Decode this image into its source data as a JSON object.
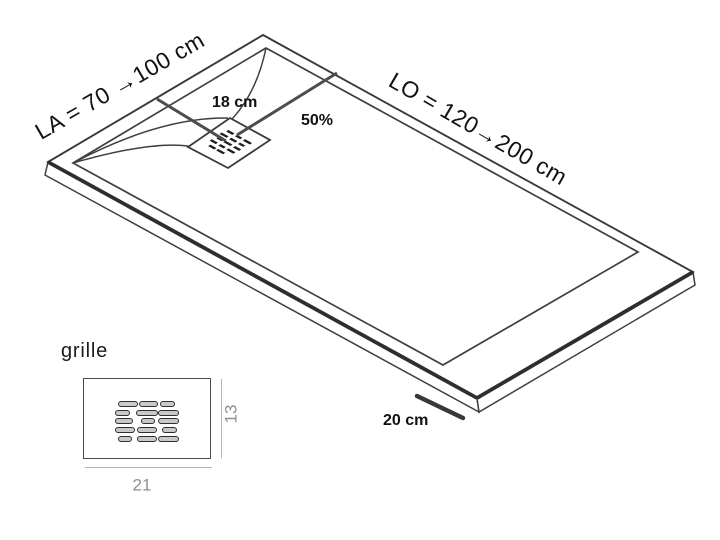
{
  "diagram": {
    "la_label": "LA = 70 →100 cm",
    "lo_label": "LO = 120→200 cm",
    "drain_distance_label": "18 cm",
    "drain_position_label": "50%",
    "border_width_label": "20 cm",
    "colors": {
      "line": "#3f3f3f",
      "thick_edge": "#2e2e2e",
      "leader": "#4d4d4d",
      "text": "#111111",
      "dim_text": "#8f8f8f",
      "slot_fill": "#c9c9c9",
      "drain_slot": "#1f1f1f"
    },
    "drain_slot_rows": [
      {
        "y": 14,
        "slots": [
          {
            "x": 10,
            "w": 7
          },
          {
            "x": 20,
            "w": 6
          },
          {
            "x": 29,
            "w": 8
          }
        ]
      },
      {
        "y": 20,
        "slots": [
          {
            "x": 8,
            "w": 8
          },
          {
            "x": 19,
            "w": 7
          },
          {
            "x": 29,
            "w": 6
          }
        ]
      },
      {
        "y": 26,
        "slots": [
          {
            "x": 10,
            "w": 6
          },
          {
            "x": 18,
            "w": 8
          },
          {
            "x": 29,
            "w": 7
          }
        ]
      },
      {
        "y": 32,
        "slots": [
          {
            "x": 8,
            "w": 7
          },
          {
            "x": 18,
            "w": 6
          },
          {
            "x": 27,
            "w": 8
          }
        ]
      },
      {
        "y": 38,
        "slots": [
          {
            "x": 12,
            "w": 7
          },
          {
            "x": 21,
            "w": 8
          }
        ]
      }
    ]
  },
  "grille_inset": {
    "title": "grille",
    "width_label": "21",
    "height_label": "13",
    "slot_rows": [
      {
        "y": 22,
        "slots": [
          {
            "x": 34,
            "w": 18
          },
          {
            "x": 55,
            "w": 17
          },
          {
            "x": 76,
            "w": 13
          }
        ]
      },
      {
        "y": 31,
        "slots": [
          {
            "x": 31,
            "w": 13
          },
          {
            "x": 52,
            "w": 20
          },
          {
            "x": 74,
            "w": 19
          }
        ]
      },
      {
        "y": 39,
        "slots": [
          {
            "x": 31,
            "w": 16
          },
          {
            "x": 57,
            "w": 12
          },
          {
            "x": 74,
            "w": 19
          }
        ]
      },
      {
        "y": 48,
        "slots": [
          {
            "x": 31,
            "w": 18
          },
          {
            "x": 53,
            "w": 18
          },
          {
            "x": 78,
            "w": 13
          }
        ]
      },
      {
        "y": 57,
        "slots": [
          {
            "x": 34,
            "w": 12
          },
          {
            "x": 53,
            "w": 18
          },
          {
            "x": 74,
            "w": 19
          }
        ]
      }
    ]
  }
}
